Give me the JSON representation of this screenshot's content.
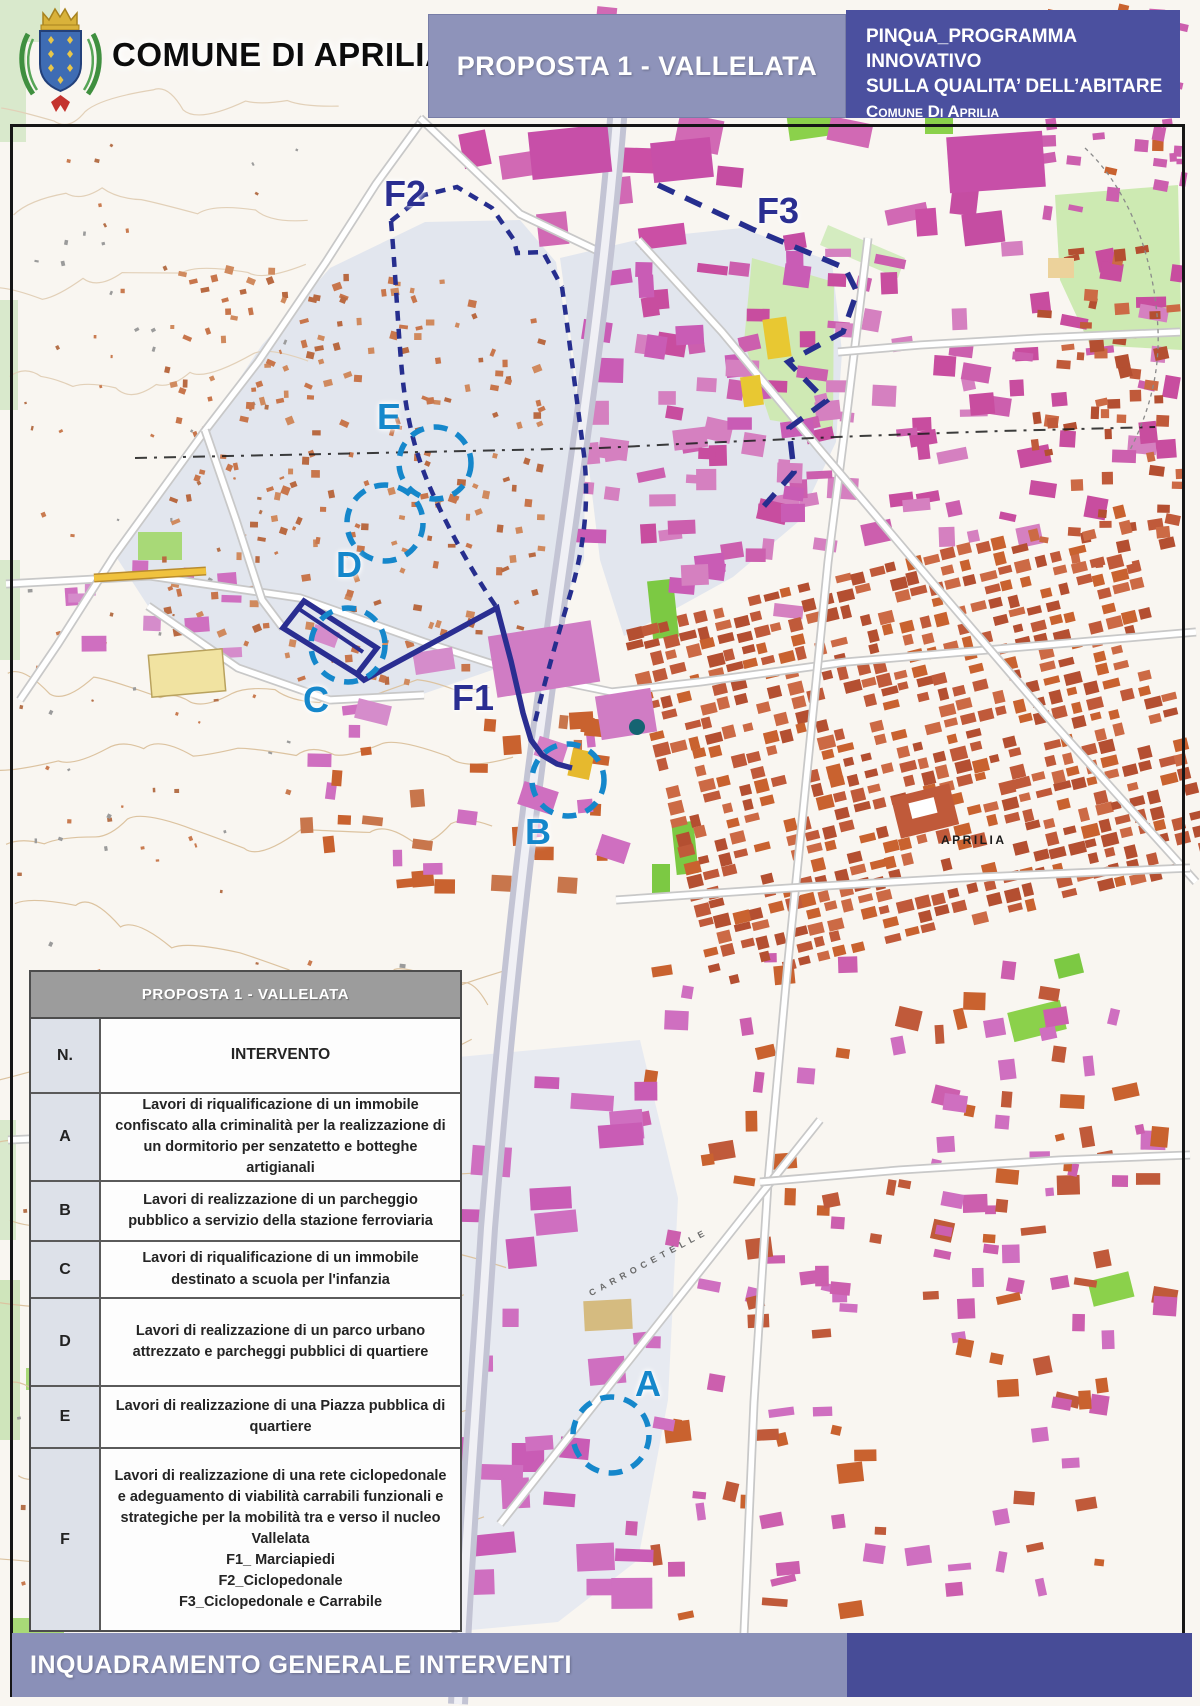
{
  "header": {
    "municipality": "COMUNE DI APRILIA",
    "proposal_title": "PROPOSTA 1 - VALLELATA",
    "program": {
      "line1": "PINQuA_PROGRAMMA INNOVATIVO",
      "line2": "SULLA QUALITA’ DELL’ABITARE",
      "line3": "Comune Di Aprilia"
    }
  },
  "map": {
    "city_label": "APRILIA",
    "road_label": "CARROCETELLE",
    "labels": [
      {
        "id": "F2",
        "text": "F2"
      },
      {
        "id": "F3",
        "text": "F3"
      },
      {
        "id": "E",
        "text": "E"
      },
      {
        "id": "D",
        "text": "D"
      },
      {
        "id": "C",
        "text": "C"
      },
      {
        "id": "F1",
        "text": "F1"
      },
      {
        "id": "B",
        "text": "B"
      },
      {
        "id": "A",
        "text": "A"
      }
    ]
  },
  "table": {
    "title": "PROPOSTA 1 - VALLELATA",
    "columns": {
      "n": "N.",
      "intervento": "INTERVENTO"
    },
    "rows": [
      {
        "n": "A",
        "text": "Lavori di riqualificazione di un immobile confiscato alla criminalità per la realizzazione di un dormitorio per senzatetto e botteghe artigianali"
      },
      {
        "n": "B",
        "text": "Lavori di realizzazione di un parcheggio pubblico a servizio della stazione ferroviaria"
      },
      {
        "n": "C",
        "text": "Lavori di riqualificazione di un immobile destinato a scuola per l'infanzia"
      },
      {
        "n": "D",
        "text": "Lavori di realizzazione di un parco urbano attrezzato e parcheggi pubblici di quartiere"
      },
      {
        "n": "E",
        "text": "Lavori di realizzazione di una Piazza pubblica di quartiere"
      },
      {
        "n": "F",
        "text": "Lavori di realizzazione di una rete ciclopedonale e adeguamento di viabilità carrabili funzionali e strategiche per la mobilità tra e verso il nucleo\nVallelata\nF1_ Marciapiedi\nF2_Ciclopedonale\nF3_Ciclopedonale e Carrabile"
      }
    ]
  },
  "footer": {
    "title": "INQUADRAMENTO GENERALE INTERVENTI"
  },
  "colors": {
    "marker_blue": "#1587cb",
    "route_navy": "#2a2e91",
    "dash_navy": "#262e8e",
    "header_lavender": "#8e93ba",
    "header_indigo": "#4b509f",
    "footer_lavender": "#8a90b8",
    "footer_indigo": "#474c97",
    "table_title_gray": "#9c9c9c",
    "table_ncol": "#dde1e9"
  }
}
